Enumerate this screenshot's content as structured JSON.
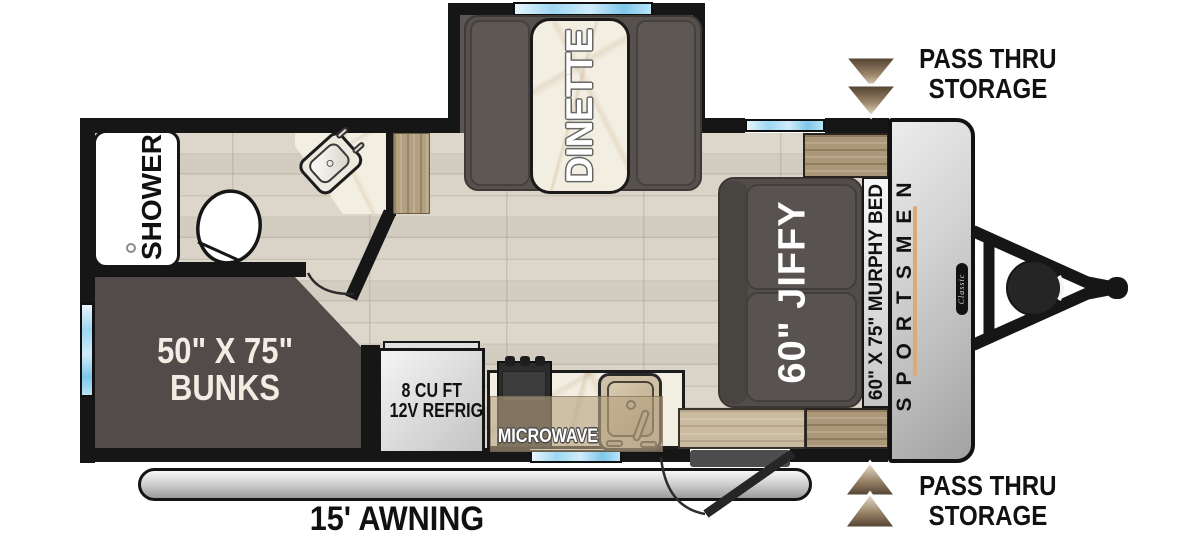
{
  "title": "Travel trailer floor plan",
  "labels": {
    "passthru_top": {
      "line1": "PASS THRU",
      "line2": "STORAGE"
    },
    "passthru_bottom": {
      "line1": "PASS THRU",
      "line2": "STORAGE"
    },
    "dinette": "DINETTE",
    "shower": "SHOWER",
    "bunks": {
      "line1": "50\" X 75\"",
      "line2": "BUNKS"
    },
    "refrigerator": {
      "line1": "8 CU FT",
      "line2": "12V REFRIG"
    },
    "microwave": "MICROWAVE",
    "sofa": "60\" JIFFY",
    "murphy_bed": "60\" X 75\" MURPHY BED",
    "brand": "SPORTSMEN",
    "series": "Classic",
    "awning": "15' AWNING"
  },
  "colors": {
    "wall": "#161616",
    "floor_wood": "#d7d1c6",
    "furniture_dark_gray": "#544f4b",
    "marble": "#f3eee2",
    "cabinet_wood_light": "#c9baa0",
    "cabinet_wood_dark": "#ab9878",
    "window_blue": "#9ed7f2",
    "arrow_gradient_dark": "#4e3e2f",
    "arrow_gradient_light": "#f0e6d6",
    "front_cap_gray": "#c9c9c9",
    "accent_stripe_tan": "#dcaa74",
    "label_cream": "#f2ede3"
  }
}
